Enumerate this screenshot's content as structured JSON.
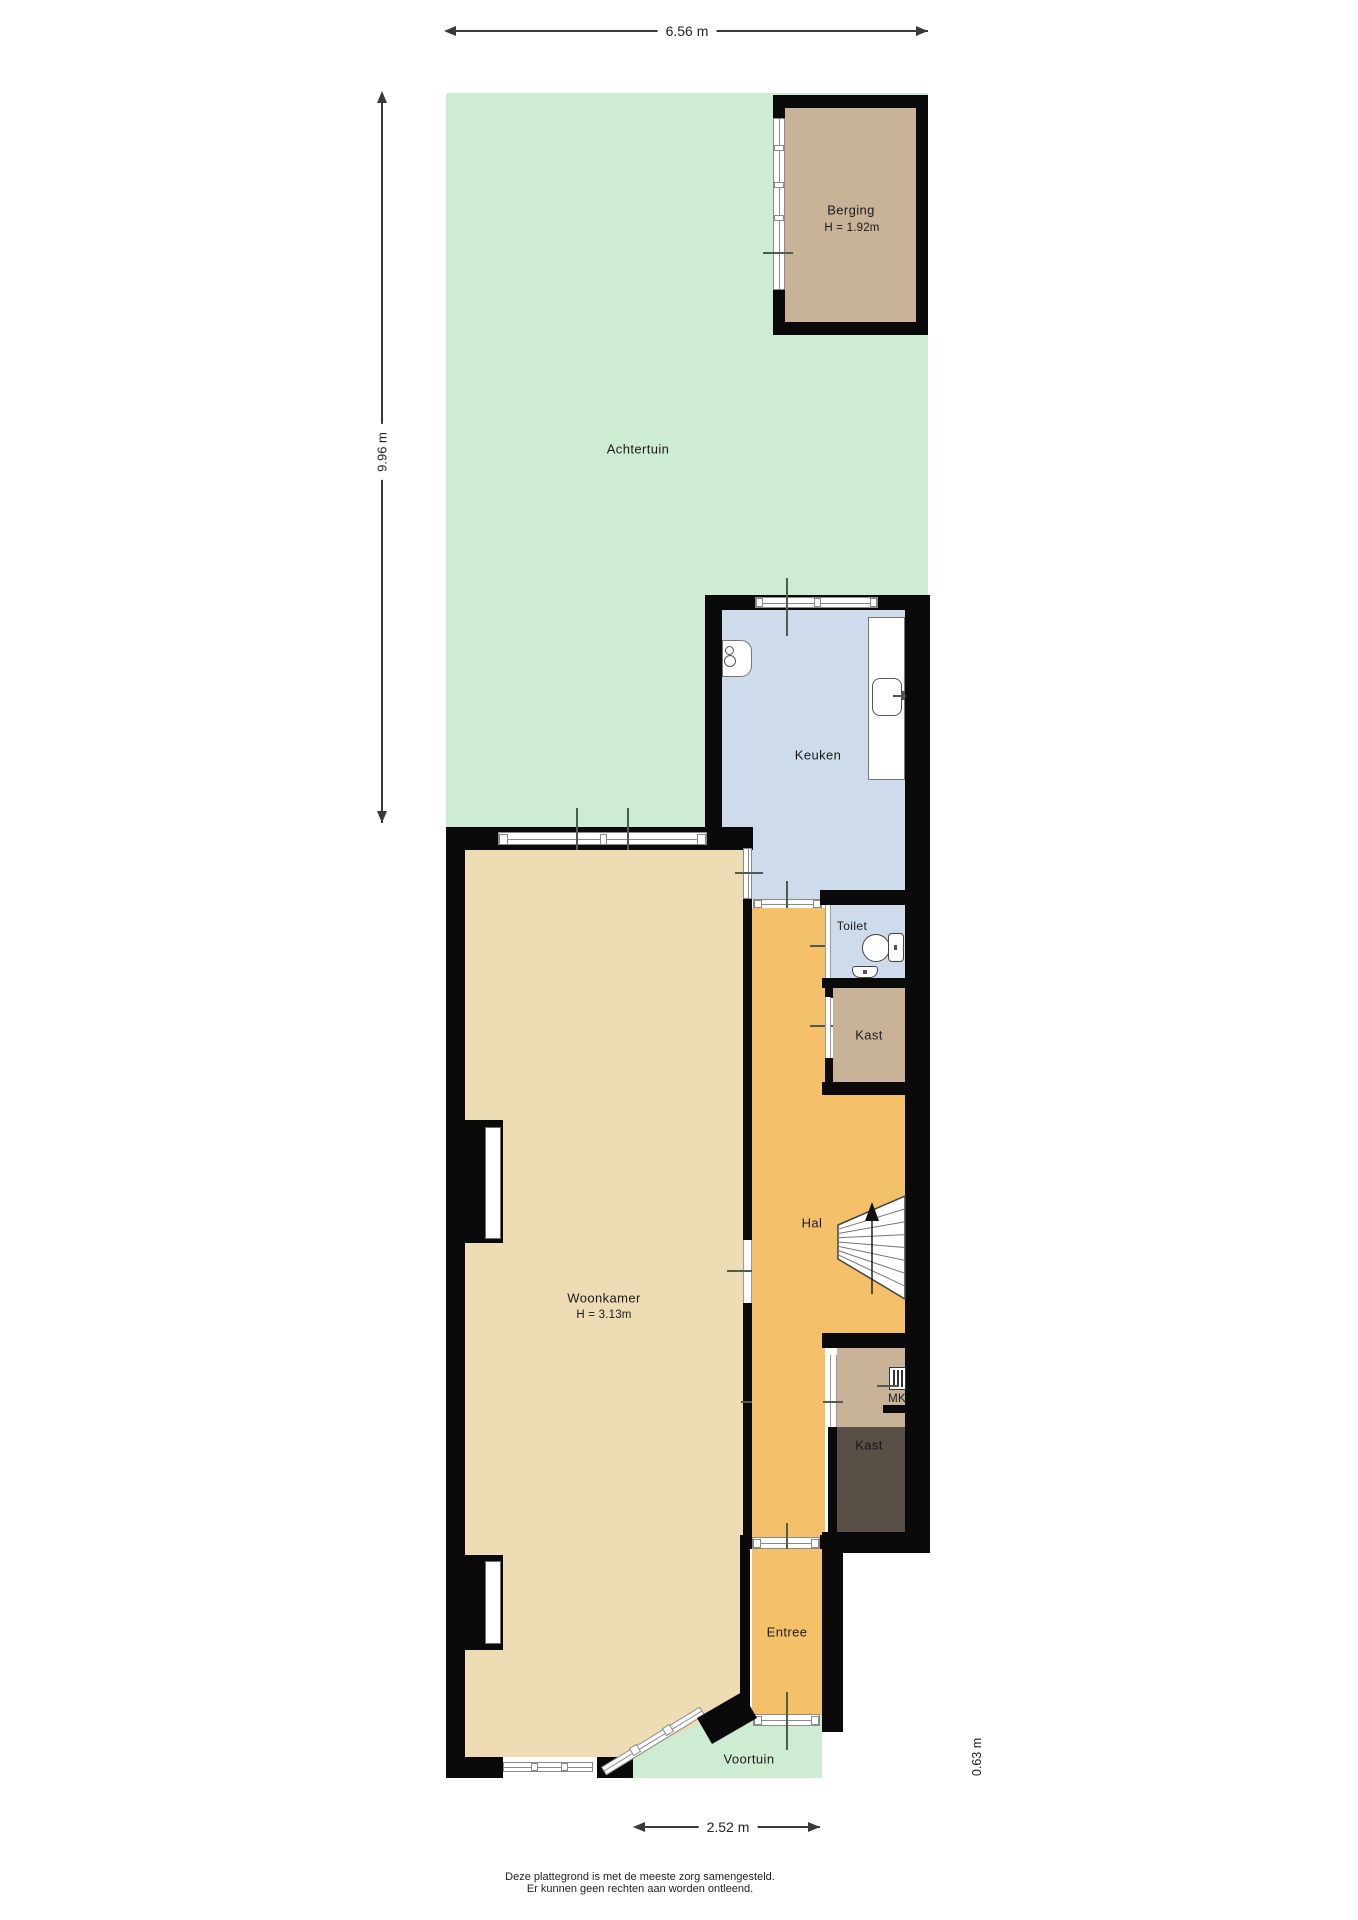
{
  "palette": {
    "wall": "#0a0a0a",
    "garden": "#cdecd1",
    "tan": "#eedcb5",
    "orange": "#f5c06a",
    "blue": "#cddbeb",
    "brown": "#c8b298",
    "darkbrown": "#584f46"
  },
  "dimensions": {
    "top": "6.56 m",
    "left": "9.96 m",
    "bottom": "2.52 m",
    "right": "0.63 m"
  },
  "rooms": {
    "achtertuin": {
      "label": "Achtertuin"
    },
    "berging": {
      "label": "Berging",
      "height": "H = 1.92m"
    },
    "keuken": {
      "label": "Keuken"
    },
    "toilet": {
      "label": "Toilet"
    },
    "kast_boven": {
      "label": "Kast"
    },
    "hal": {
      "label": "Hal"
    },
    "mk": {
      "label": "MK"
    },
    "kast_onder": {
      "label": "Kast"
    },
    "woonkamer": {
      "label": "Woonkamer",
      "height": "H = 3.13m"
    },
    "entree": {
      "label": "Entree"
    },
    "voortuin": {
      "label": "Voortuin"
    }
  },
  "footer": {
    "line1": "Deze plattegrond is met de meeste zorg samengesteld.",
    "line2": "Er kunnen geen rechten aan worden ontleend."
  }
}
